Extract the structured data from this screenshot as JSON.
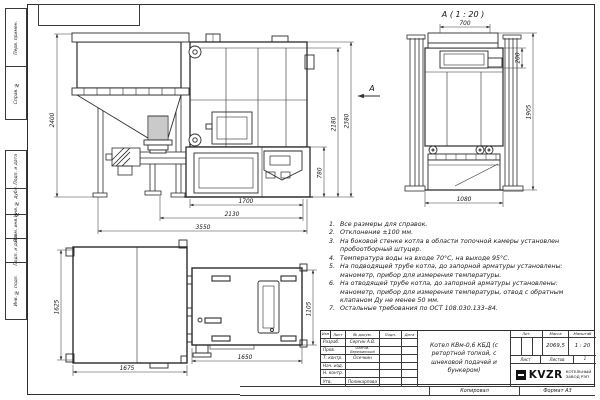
{
  "frame": {
    "left_labels": [
      "Перв. примен.",
      "Справ. №",
      "Подп. и дата",
      "Инв. № дубл.",
      "Взам. инв. №",
      "Подп. и дата",
      "Инв. № подл."
    ],
    "bottom": {
      "copied": "Копировал",
      "format": "Формат А3"
    }
  },
  "views": {
    "front": {
      "arrow_label": "А",
      "dims": {
        "bunker_h": "2400",
        "total_h": "2380",
        "body_h": "2180",
        "ash_h": "780",
        "w1": "1700",
        "w2": "2130",
        "w3": "3550"
      }
    },
    "rear": {
      "title": "А ( 1 : 20 )",
      "dims": {
        "top": "700",
        "collar": "200",
        "h": "1905",
        "w": "1080"
      }
    },
    "plan": {
      "dims": {
        "left_h": "1625",
        "left_w": "1675",
        "right_w": "1650",
        "right_h": "1105"
      }
    }
  },
  "notes": {
    "items": [
      {
        "n": "1.",
        "text": "Все размеры для справок."
      },
      {
        "n": "2.",
        "text": "Отклонение ±100 мм."
      },
      {
        "n": "3.",
        "text": "На боковой стенке котла в области топочной камеры установлен пробоотборный штуцер."
      },
      {
        "n": "4.",
        "text": "Температура воды на входе 70°С, на выходе 95°С."
      },
      {
        "n": "5.",
        "text": "На подводящей трубе котла, до запорной арматуры установлены: манометр, прибор для измерения температуры."
      },
      {
        "n": "6.",
        "text": "На отводящей трубе котла, до запорной арматуры установлены: манометр, прибор для измерения температуры, отвод с обратным клапаном Ду не менее 50 мм."
      },
      {
        "n": "7.",
        "text": "Остальные требования по ОСТ 108.030.133–84."
      }
    ]
  },
  "title_block": {
    "header_cols": [
      "Изм",
      "Лист",
      "№ докум.",
      "Подп.",
      "Дата"
    ],
    "rows": [
      {
        "label": "Разраб.",
        "value": "Сергин А.В."
      },
      {
        "label": "Пров.",
        "value": "Олегов-Вережинский"
      },
      {
        "label": "Т. контр.",
        "value": "Осечкин"
      },
      {
        "label": "Нач. изд.",
        "value": ""
      },
      {
        "label": "Н. контр.",
        "value": ""
      },
      {
        "label": "Утв.",
        "value": "Поликарпова"
      }
    ],
    "title": "Котел КВм-0,6 КБД (с ретортной топкой, с шнековой подачей и бункером)",
    "lit_label": "Лит.",
    "mass_label": "Масса",
    "scale_label": "Масштаб",
    "mass": "2069,5",
    "scale": "1 : 20",
    "sheet_label": "Лист",
    "sheets_label": "Листов",
    "sheets_value": "1",
    "logo_text": "KVZR",
    "company_line1": "КОТЕЛЬНЫЙ",
    "company_line2": "ЗАВОД РЭП"
  },
  "colors": {
    "line": "#2b2b2b",
    "dim": "#3c3c3c",
    "paper": "#ffffff"
  }
}
